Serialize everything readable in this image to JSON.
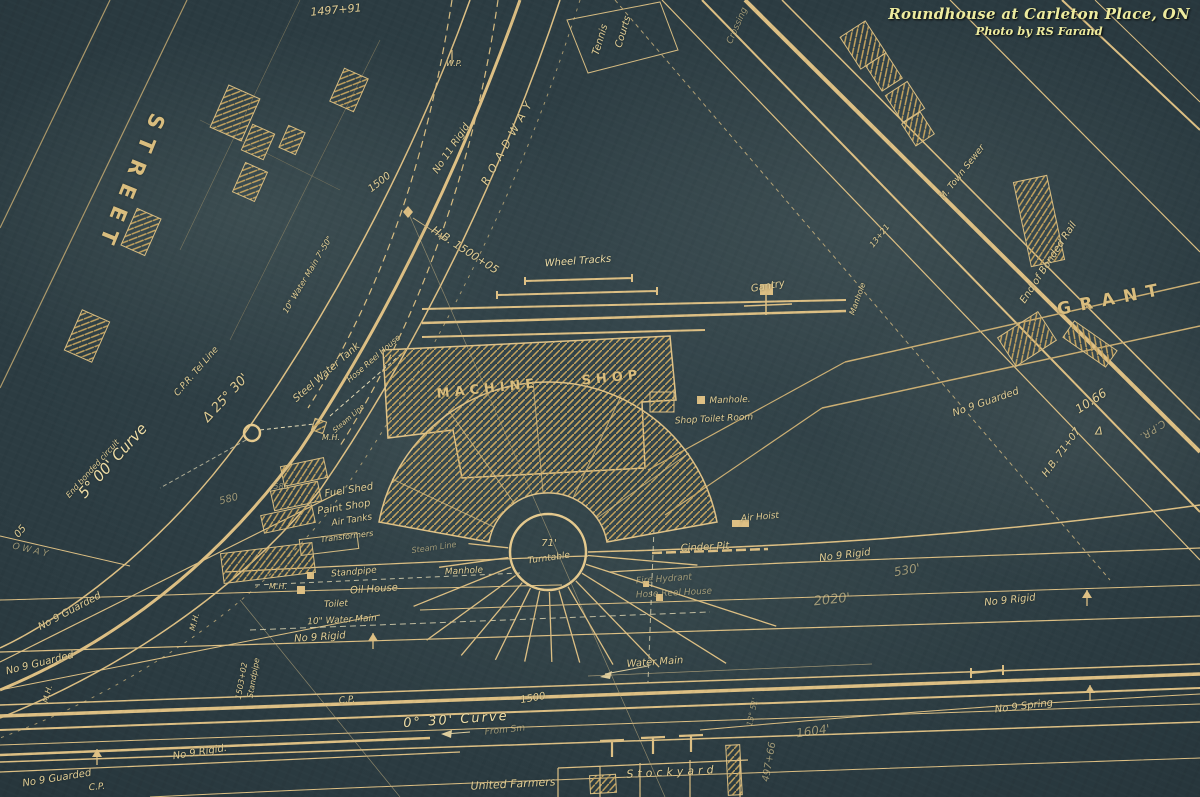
{
  "credit": {
    "title": "Roundhouse at Carleton Place, ON",
    "byline": "Photo by RS Farand"
  },
  "colors": {
    "background": "#2b3b41",
    "ink": "#d6b878",
    "ink_bright": "#f0da9e",
    "credit_text": "#edeb9e"
  },
  "labels": [
    {
      "n": "station-1497-91",
      "t": "1497+91",
      "x": 336,
      "y": 10,
      "r": -5,
      "s": 11
    },
    {
      "n": "street-name",
      "t": "STREET",
      "x": 130,
      "y": 183,
      "r": 112,
      "s": 21,
      "ls": 10,
      "c": "big"
    },
    {
      "n": "tennis-line1",
      "t": "Tennis",
      "x": 601,
      "y": 40,
      "r": -73,
      "s": 10
    },
    {
      "n": "tennis-line2",
      "t": "Courts",
      "x": 624,
      "y": 32,
      "r": -73,
      "s": 10
    },
    {
      "n": "crossing",
      "t": "Crossing",
      "x": 738,
      "y": 26,
      "r": -66,
      "s": 9,
      "c": "dim"
    },
    {
      "n": "wp-marker",
      "t": "W.P.",
      "x": 454,
      "y": 64,
      "r": 0,
      "s": 8
    },
    {
      "n": "no11-rigid",
      "t": "No 11 Rigid",
      "x": 452,
      "y": 149,
      "r": -56,
      "s": 10
    },
    {
      "n": "roadway",
      "t": "ROADWAY",
      "x": 508,
      "y": 141,
      "r": -61,
      "s": 11,
      "ls": 6
    },
    {
      "n": "station-1500-road",
      "t": "1500",
      "x": 380,
      "y": 183,
      "r": -38,
      "s": 10
    },
    {
      "n": "hb-1500-05",
      "t": "H.B. 1500+05",
      "x": 465,
      "y": 250,
      "r": 33,
      "s": 11
    },
    {
      "n": "water-main-10in-street",
      "t": "10\" Water Main 7'-50\"",
      "x": 308,
      "y": 275,
      "r": -59,
      "s": 8
    },
    {
      "n": "wheel-tracks",
      "t": "Wheel Tracks",
      "x": 578,
      "y": 262,
      "r": -4,
      "s": 10,
      "c": "bright"
    },
    {
      "n": "gantry",
      "t": "Gantry",
      "x": 768,
      "y": 287,
      "r": -10,
      "s": 10
    },
    {
      "n": "manhole-ne",
      "t": "Manhole",
      "x": 858,
      "y": 299,
      "r": -70,
      "s": 8
    },
    {
      "n": "station-13-21",
      "t": "13+21",
      "x": 880,
      "y": 236,
      "r": -52,
      "s": 8
    },
    {
      "n": "town-sewer",
      "t": "M. Town Sewer",
      "x": 963,
      "y": 173,
      "r": -52,
      "s": 9
    },
    {
      "n": "end-of-bonded-rail",
      "t": "End of Bonded Rail",
      "x": 1049,
      "y": 263,
      "r": -57,
      "s": 10
    },
    {
      "n": "grant-street",
      "t": "GRANT",
      "x": 1112,
      "y": 300,
      "r": -11,
      "s": 17,
      "ls": 9,
      "c": "big"
    },
    {
      "n": "no9-guarded-east",
      "t": "No 9 Guarded",
      "x": 986,
      "y": 403,
      "r": -19,
      "s": 10
    },
    {
      "n": "dim-10-66",
      "t": "10.66",
      "x": 1091,
      "y": 401,
      "r": -33,
      "s": 12
    },
    {
      "n": "delta-east",
      "t": "Δ",
      "x": 1099,
      "y": 431,
      "r": 0,
      "s": 11
    },
    {
      "n": "cpr-east",
      "t": "C.P.R.",
      "x": 1152,
      "y": 429,
      "r": 147,
      "s": 10,
      "c": "dim"
    },
    {
      "n": "hb-71-07",
      "t": "H.B. 71+07",
      "x": 1062,
      "y": 453,
      "r": -54,
      "s": 10
    },
    {
      "n": "steel-water-tank",
      "t": "Steel Water Tank",
      "x": 327,
      "y": 373,
      "r": -41,
      "s": 10
    },
    {
      "n": "hose-reel-house-1",
      "t": "Hose Reel House",
      "x": 374,
      "y": 359,
      "r": -41,
      "s": 8
    },
    {
      "n": "steam-line-1",
      "t": "Steam Line",
      "x": 349,
      "y": 419,
      "r": -41,
      "s": 7
    },
    {
      "n": "mh-tank",
      "t": "M.H.",
      "x": 331,
      "y": 438,
      "r": 0,
      "s": 8
    },
    {
      "n": "cpr-tel-line",
      "t": "C.P.R. Tel Line",
      "x": 197,
      "y": 372,
      "r": -49,
      "s": 9
    },
    {
      "n": "delta-25-30",
      "t": "Δ 25° 30'",
      "x": 226,
      "y": 398,
      "r": -47,
      "s": 13
    },
    {
      "n": "curve-5-00",
      "t": "5° 00' Curve",
      "x": 113,
      "y": 461,
      "r": -48,
      "s": 15,
      "c": "bright"
    },
    {
      "n": "end-bonded-circuit",
      "t": "End bonded circuit",
      "x": 93,
      "y": 469,
      "r": -48,
      "s": 8
    },
    {
      "n": "station-05",
      "t": "05",
      "x": 21,
      "y": 532,
      "r": -50,
      "s": 10
    },
    {
      "n": "num-580",
      "t": "580",
      "x": 229,
      "y": 500,
      "r": -15,
      "s": 10,
      "c": "dim"
    },
    {
      "n": "num-586",
      "t": "586",
      "x": 281,
      "y": 487,
      "r": 0,
      "s": 8,
      "c": "dim"
    },
    {
      "n": "fuel-shed",
      "t": "Fuel Shed",
      "x": 349,
      "y": 491,
      "r": -9,
      "s": 10
    },
    {
      "n": "paint-shop",
      "t": "Paint Shop",
      "x": 344,
      "y": 508,
      "r": -9,
      "s": 10
    },
    {
      "n": "air-tanks",
      "t": "Air Tanks",
      "x": 352,
      "y": 521,
      "r": -9,
      "s": 9
    },
    {
      "n": "transformers",
      "t": "Transformers",
      "x": 347,
      "y": 537,
      "r": -7,
      "s": 8
    },
    {
      "n": "steam-line-2",
      "t": "Steam Line",
      "x": 434,
      "y": 548,
      "r": -8,
      "s": 8,
      "c": "dim"
    },
    {
      "n": "standpipe",
      "t": "Standpipe",
      "x": 354,
      "y": 573,
      "r": -5,
      "s": 9
    },
    {
      "n": "manhole-yard",
      "t": "Manhole",
      "x": 464,
      "y": 572,
      "r": -3,
      "s": 9
    },
    {
      "n": "oil-house",
      "t": "Oil House",
      "x": 374,
      "y": 590,
      "r": -4,
      "s": 10
    },
    {
      "n": "mh-west",
      "t": "M.H.",
      "x": 278,
      "y": 587,
      "r": 0,
      "s": 8
    },
    {
      "n": "toilet",
      "t": "Toilet",
      "x": 336,
      "y": 605,
      "r": -3,
      "s": 9
    },
    {
      "n": "water-main-10in-yard",
      "t": "10\" Water Main",
      "x": 342,
      "y": 621,
      "r": -3,
      "s": 9
    },
    {
      "n": "no9-rigid-a",
      "t": "No 9 Rigid",
      "x": 320,
      "y": 638,
      "r": -4,
      "s": 10
    },
    {
      "n": "no9-rigid-b",
      "t": "No 9 Rigid.",
      "x": 200,
      "y": 753,
      "r": -9,
      "s": 10
    },
    {
      "n": "no9-rigid-c",
      "t": "No 9 Rigid",
      "x": 1010,
      "y": 601,
      "r": -6,
      "s": 10
    },
    {
      "n": "no9-spring",
      "t": "No 9 Spring",
      "x": 1024,
      "y": 707,
      "r": -7,
      "s": 10
    },
    {
      "n": "no9-rigid-d",
      "t": "No 9 Rigid",
      "x": 845,
      "y": 556,
      "r": -7,
      "s": 10
    },
    {
      "n": "len-530",
      "t": "530'",
      "x": 907,
      "y": 570,
      "r": -10,
      "s": 12,
      "c": "dim"
    },
    {
      "n": "len-2020",
      "t": "2020'",
      "x": 832,
      "y": 600,
      "r": -6,
      "s": 13,
      "c": "dim"
    },
    {
      "n": "air-hoist",
      "t": "Air Hoist",
      "x": 760,
      "y": 518,
      "r": -5,
      "s": 9
    },
    {
      "n": "cinder-pit",
      "t": "Cinder Pit",
      "x": 705,
      "y": 548,
      "r": -3,
      "s": 10
    },
    {
      "n": "fire-hydrant",
      "t": "Fire Hydrant",
      "x": 664,
      "y": 580,
      "r": -4,
      "s": 9,
      "c": "dim"
    },
    {
      "n": "hose-reel-house-2",
      "t": "Hose Reel House",
      "x": 674,
      "y": 594,
      "r": -3,
      "s": 9,
      "c": "dim"
    },
    {
      "n": "turntable-size",
      "t": "71'",
      "x": 549,
      "y": 544,
      "r": 0,
      "s": 10
    },
    {
      "n": "turntable",
      "t": "Turntable",
      "x": 549,
      "y": 559,
      "r": -8,
      "s": 9
    },
    {
      "n": "machine-shop-1",
      "t": "MACHINE",
      "x": 488,
      "y": 389,
      "r": -6,
      "s": 13,
      "ls": 5,
      "c": "big"
    },
    {
      "n": "machine-shop-2",
      "t": "SHOP",
      "x": 612,
      "y": 378,
      "r": -6,
      "s": 13,
      "ls": 5,
      "c": "big"
    },
    {
      "n": "manhole-shop",
      "t": "Manhole.",
      "x": 730,
      "y": 401,
      "r": -2,
      "s": 9
    },
    {
      "n": "shop-toilet-room",
      "t": "Shop Toilet Room",
      "x": 714,
      "y": 420,
      "r": -3,
      "s": 9
    },
    {
      "n": "water-main-south",
      "t": "Water Main",
      "x": 655,
      "y": 663,
      "r": -4,
      "s": 10
    },
    {
      "n": "curve-0-30",
      "t": "0° 30' Curve",
      "x": 456,
      "y": 720,
      "r": -4,
      "s": 13,
      "ls": 2,
      "c": "bright"
    },
    {
      "n": "station-1500-south",
      "t": "1500",
      "x": 533,
      "y": 699,
      "r": -10,
      "s": 10
    },
    {
      "n": "from-note",
      "t": "From Sm",
      "x": 505,
      "y": 731,
      "r": -6,
      "s": 9,
      "c": "dim"
    },
    {
      "n": "cp-mid",
      "t": "C.P.",
      "x": 347,
      "y": 701,
      "r": -5,
      "s": 9
    },
    {
      "n": "stockyard",
      "t": "Stockyard",
      "x": 672,
      "y": 772,
      "r": -3,
      "s": 11,
      "ls": 4
    },
    {
      "n": "united-farmers",
      "t": "United Farmers",
      "x": 513,
      "y": 784,
      "r": -3,
      "s": 11
    },
    {
      "n": "len-1604",
      "t": "1604'",
      "x": 813,
      "y": 731,
      "r": -8,
      "s": 12,
      "c": "dim"
    },
    {
      "n": "station-497-66",
      "t": "497+66",
      "x": 770,
      "y": 762,
      "r": -80,
      "s": 10,
      "c": "dim"
    },
    {
      "n": "station-13-51",
      "t": "13° 51'",
      "x": 753,
      "y": 712,
      "r": -78,
      "s": 8,
      "c": "dim"
    },
    {
      "n": "station-1503-02",
      "t": "1503+02",
      "x": 242,
      "y": 681,
      "r": -80,
      "s": 8
    },
    {
      "n": "standpipe-station",
      "t": "Standpipe",
      "x": 254,
      "y": 678,
      "r": -80,
      "s": 8
    },
    {
      "n": "no9-guarded-w1",
      "t": "No 9 Guarded",
      "x": 70,
      "y": 612,
      "r": -28,
      "s": 10
    },
    {
      "n": "no9-guarded-w2",
      "t": "No 9 Guarded",
      "x": 40,
      "y": 664,
      "r": -14,
      "s": 10
    },
    {
      "n": "no9-guarded-w3",
      "t": "No 9 Guarded",
      "x": 57,
      "y": 779,
      "r": -9,
      "s": 10
    },
    {
      "n": "cp-southwest",
      "t": "C.P.",
      "x": 97,
      "y": 788,
      "r": -5,
      "s": 9
    },
    {
      "n": "mh-sw1",
      "t": "M.H.",
      "x": 48,
      "y": 694,
      "r": -75,
      "s": 8
    },
    {
      "n": "mh-sw2",
      "t": "M.H.",
      "x": 195,
      "y": 622,
      "r": -75,
      "s": 8
    },
    {
      "n": "partial-oway",
      "t": "O W A Y",
      "x": 30,
      "y": 551,
      "r": 13,
      "s": 9,
      "c": "dim"
    }
  ]
}
